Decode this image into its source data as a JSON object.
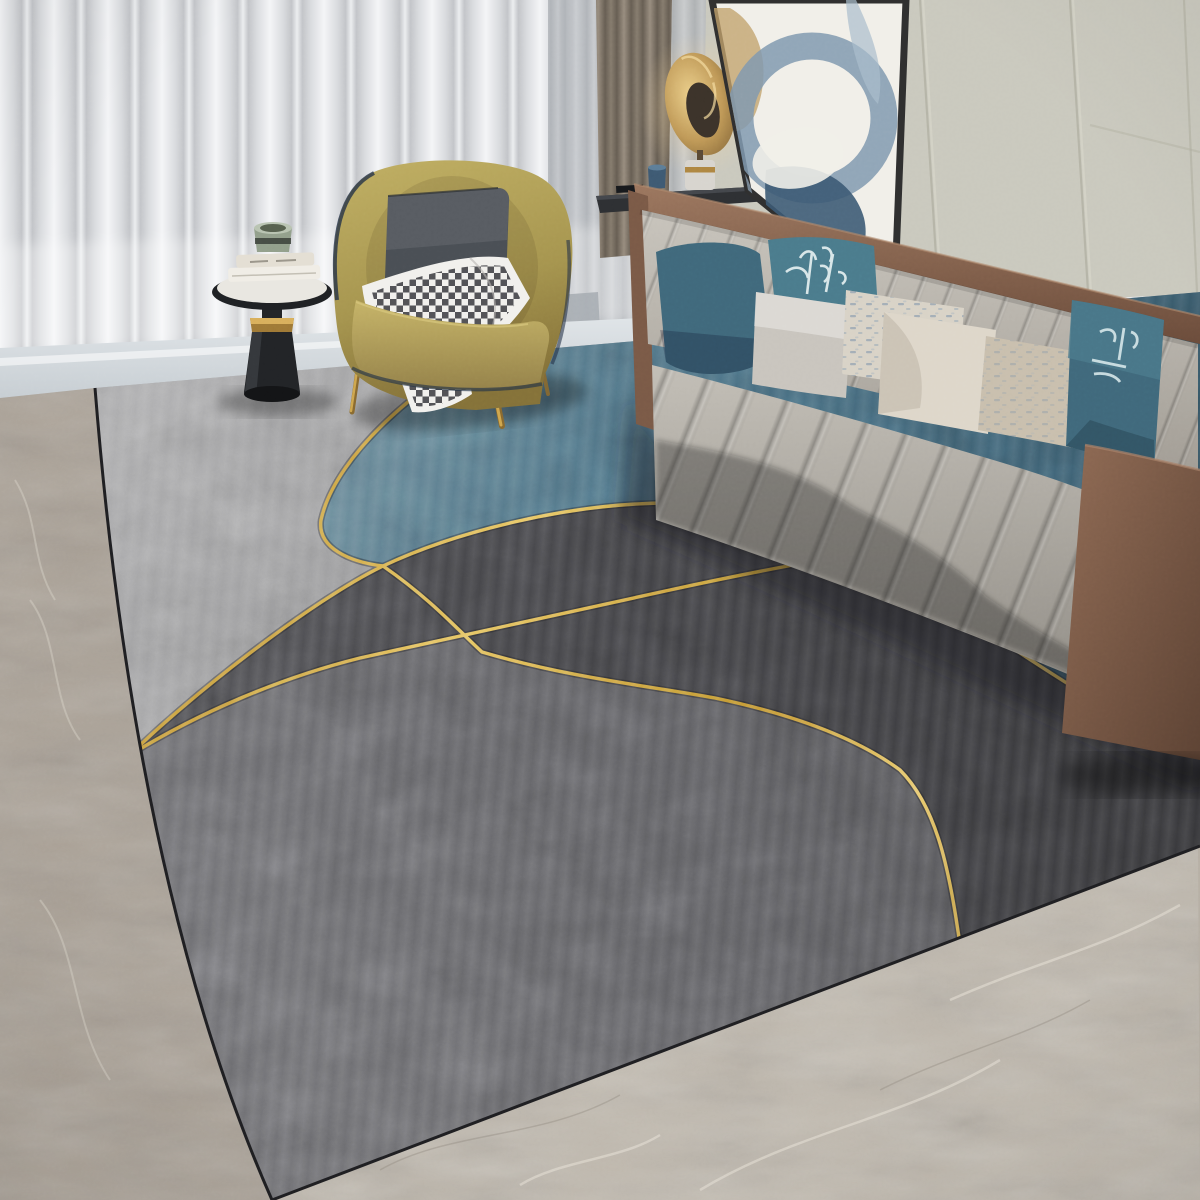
{
  "scene": {
    "description": "Modern living room photo: gray channel-tufted sofa with blue and patterned pillows, mustard leather armchair with checkered throw, black round side table with books and cup, gold oval floor lamp, abstract wall art, sheer curtains, and a large abstract area rug with teal and charcoal circles outlined in thin gold lines on marble flooring",
    "objects": {
      "rug": "abstract gray rug with teal circle and gold arcs",
      "sofa": "channel tufted light gray sofa with brown leather trim",
      "armchair": "mustard leather tub chair",
      "side_table": "round black pedestal side table",
      "lamp": "gold oval sculptural lamp",
      "art": "leaning abstract framed artwork",
      "floor": "gray marble floor",
      "curtains": "white sheer and taupe curtains",
      "wall": "beige paneled wall"
    }
  },
  "colors": {
    "wall": "#cdccbf",
    "wall_seam": "#b2b1a3",
    "curtain_sheer": "#e6e8ea",
    "curtain_taupe": "#7d7366",
    "window_sill": "#a7adb2",
    "console_top": "#2e3033",
    "console_cup": "#3e5a73",
    "lamp_core": "#3c332a",
    "lamp_base": "#e7e4dd",
    "art_bg": "#f1efe9",
    "art_blue": "#8099af",
    "art_navy": "#3c5a74",
    "art_tan": "#c2a26b",
    "art_steel": "#93a8ba",
    "sofa_fabric": "#bdb8b0",
    "sofa_leather": "#8a6752",
    "pillow_teal_solid": "#40697c",
    "pillow_teal_pattern": "#4b7c8d",
    "pillow_teal_right": "#41718444",
    "pillow_gray": "#c9c5be",
    "pillow_lumbar": "#d9d3c7",
    "pillow_cream": "#ded7ca",
    "pillow_tan": "#c9bfae",
    "chair_pillow": "#4a4f55",
    "throw_white": "#f1f0ed",
    "throw_check": "#2e2e33",
    "table_black": "#232528",
    "table_gold": "#bb9147",
    "table_top": "#e9e7e1",
    "cup_sage": "#93a08c",
    "book_white": "#f0ede6",
    "floor_bright": "#dde3e7",
    "floor_left": "#aaa196",
    "floor_bottom": "#c0b9ae",
    "rug_light": "#9b9b9d",
    "rug_blue": "#4a7084",
    "rug_charcoal": "#47474b",
    "rug_medium": "#646468",
    "rug_gold": "#d9a93f"
  }
}
